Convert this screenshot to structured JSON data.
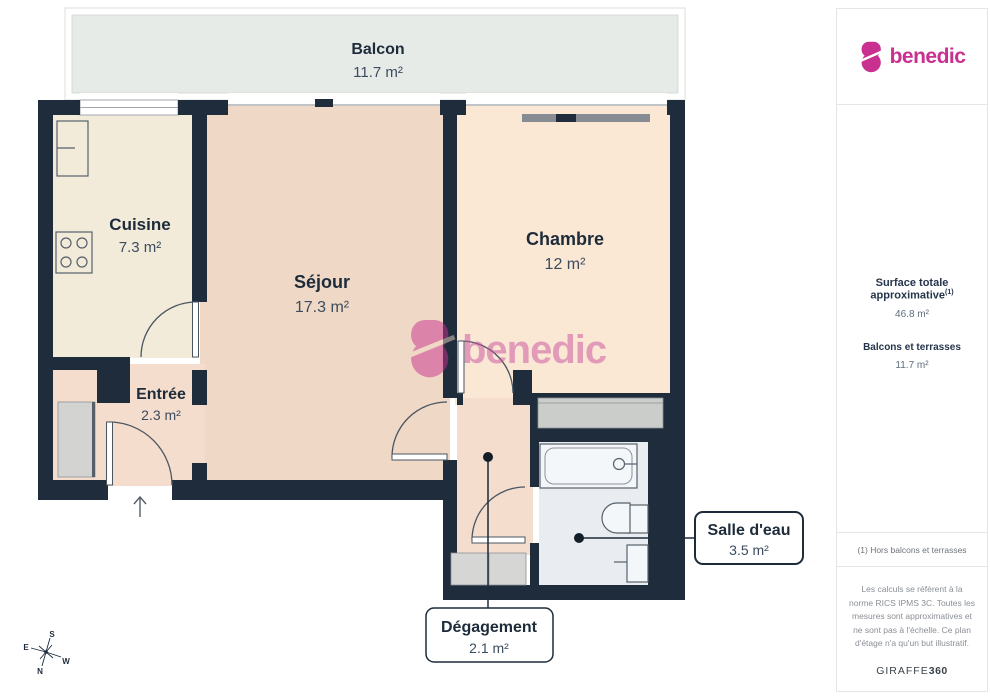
{
  "brand": {
    "name": "benedic",
    "color": "#c9308f"
  },
  "plan": {
    "rooms": [
      {
        "id": "balcon",
        "name": "Balcon",
        "area": "11.7 m²"
      },
      {
        "id": "cuisine",
        "name": "Cuisine",
        "area": "7.3 m²"
      },
      {
        "id": "sejour",
        "name": "Séjour",
        "area": "17.3 m²"
      },
      {
        "id": "chambre",
        "name": "Chambre",
        "area": "12 m²"
      },
      {
        "id": "entree",
        "name": "Entrée",
        "area": "2.3 m²"
      },
      {
        "id": "salle_deau",
        "name": "Salle d'eau",
        "area": "3.5 m²"
      },
      {
        "id": "degagement",
        "name": "Dégagement",
        "area": "2.1 m²"
      }
    ],
    "compass": {
      "n": "N",
      "s": "S",
      "e": "E",
      "w": "W"
    },
    "colors": {
      "wall": "#1e2c3c",
      "cuisine": "#f2ebd9",
      "sejour": "#efd8c5",
      "chambre": "#fae8d5",
      "entree": "#f4ddcc",
      "bathroom": "#e9edf2",
      "balcony": "#e7ebe7"
    }
  },
  "watermark": {
    "text": "benedic"
  },
  "sidebar": {
    "surface_title": "Surface totale approximative",
    "surface_sup": "(1)",
    "surface_value": "46.8 m²",
    "balconies_title": "Balcons et terrasses",
    "balconies_value": "11.7 m²",
    "footnote": "(1) Hors balcons et terrasses",
    "legal": "Les calculs se réfèrent à la norme RICS IPMS 3C. Toutes les mesures sont approximatives et ne sont pas à l'échelle. Ce plan d'étage n'a qu'un but illustratif.",
    "provider_name": "GIRAFFE",
    "provider_suffix": "360"
  }
}
